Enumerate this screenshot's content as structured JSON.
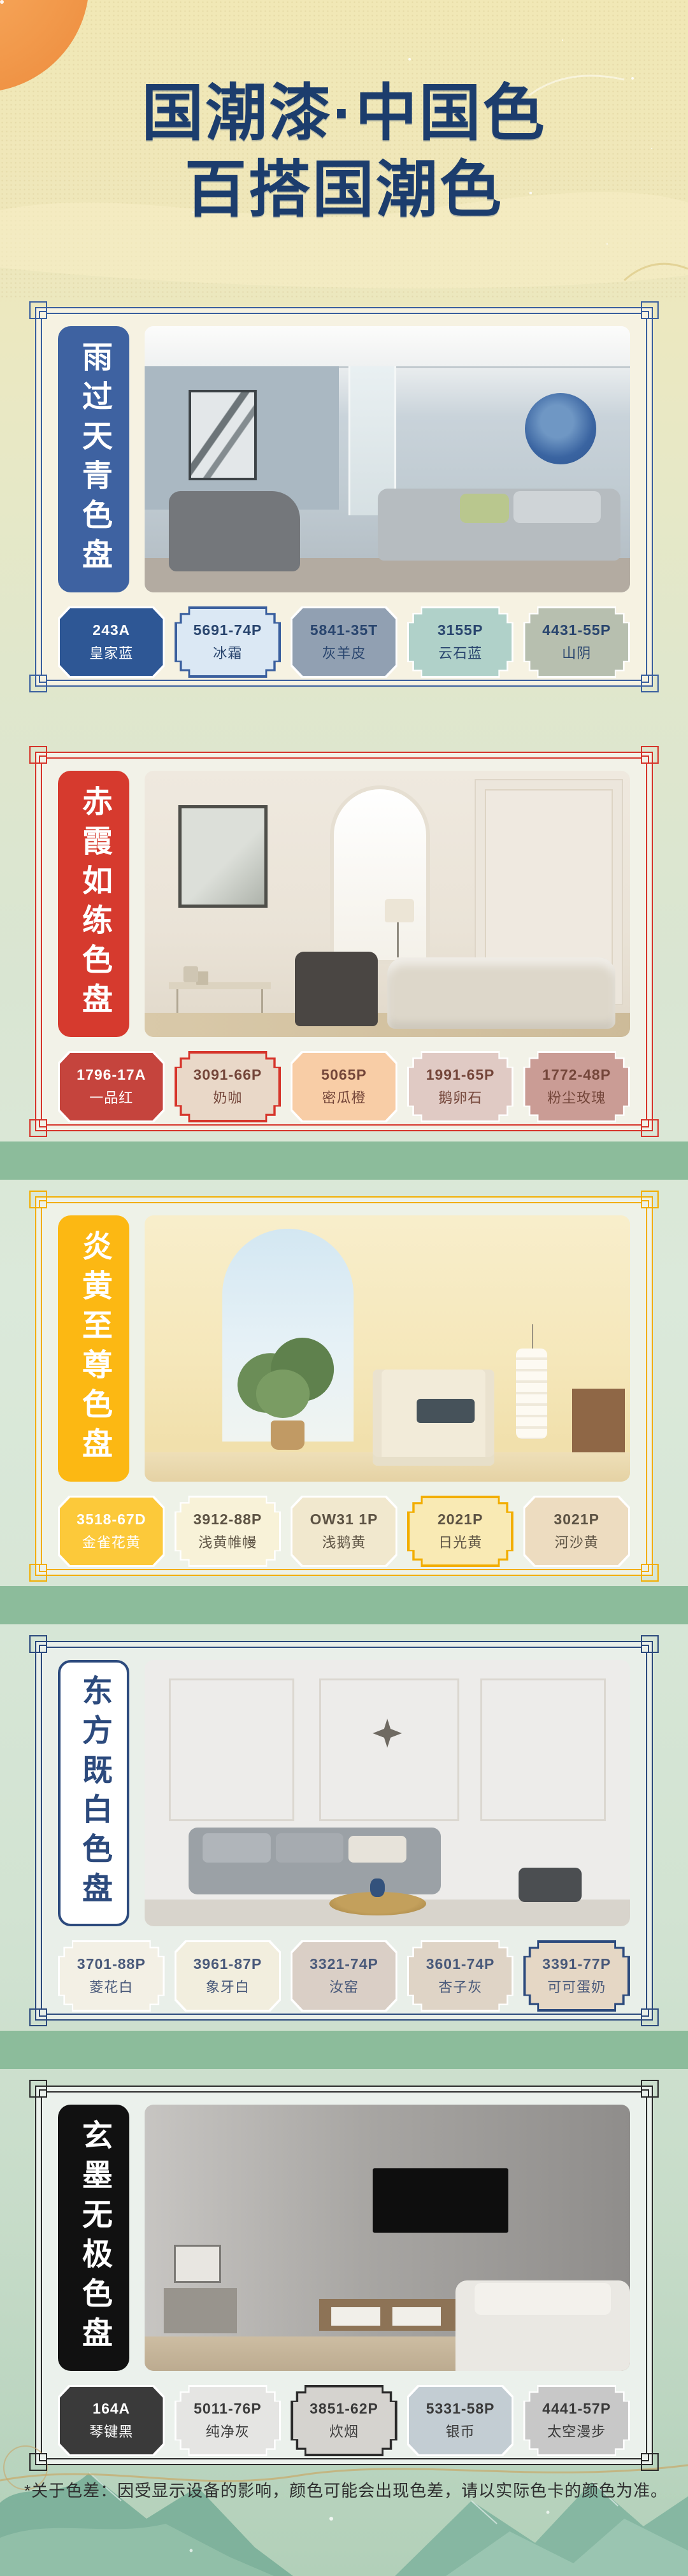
{
  "header": {
    "title_line1": "国潮漆·中国色",
    "title_line2": "百搭国潮色",
    "title_color": "#1c3d6d"
  },
  "footer": {
    "note": "*关于色差：因受显示设备的影响，颜色可能会出现色差，请以实际色卡的颜色为准。"
  },
  "page_colors": {
    "background_top": "#f1e8b6",
    "background_bottom": "#b2d0b9",
    "divider_stripe": "#8cbc9b",
    "sun": "#f29a4c"
  },
  "palettes": [
    {
      "title": "雨过天青色盘",
      "frame": "#3a5f9e",
      "banner_bg": "#3e62a1",
      "banner_text": "#ffffff",
      "banner_border": "",
      "card_bg": "#f6f2e2",
      "dark_text": "#29456e",
      "swatches": [
        {
          "code": "243A",
          "name": "皇家蓝",
          "color": "#2e5795",
          "light": false,
          "shape": "a",
          "outlined": false
        },
        {
          "code": "5691-74P",
          "name": "冰霜",
          "color": "#dbe8f4",
          "light": true,
          "shape": "b",
          "outlined": true
        },
        {
          "code": "5841-35T",
          "name": "灰羊皮",
          "color": "#91a0b2",
          "light": true,
          "shape": "a",
          "outlined": false
        },
        {
          "code": "3155P",
          "name": "云石蓝",
          "color": "#b0d1c9",
          "light": true,
          "shape": "b",
          "outlined": false
        },
        {
          "code": "4431-55P",
          "name": "山阴",
          "color": "#b7bfaf",
          "light": true,
          "shape": "b",
          "outlined": false
        }
      ]
    },
    {
      "title": "赤霞如练色盘",
      "frame": "#d6352b",
      "banner_bg": "#d63a2e",
      "banner_text": "#ffffff",
      "banner_border": "",
      "card_bg": "#f2f2e8",
      "dark_text": "#74463a",
      "swatches": [
        {
          "code": "1796-17A",
          "name": "一品红",
          "color": "#c5443d",
          "light": false,
          "shape": "a",
          "outlined": false
        },
        {
          "code": "3091-66P",
          "name": "奶咖",
          "color": "#e9d8c8",
          "light": true,
          "shape": "b",
          "outlined": true
        },
        {
          "code": "5065P",
          "name": "密瓜橙",
          "color": "#f8cda6",
          "light": true,
          "shape": "a",
          "outlined": false
        },
        {
          "code": "1991-65P",
          "name": "鹅卵石",
          "color": "#e0cac4",
          "light": true,
          "shape": "b",
          "outlined": false
        },
        {
          "code": "1772-48P",
          "name": "粉尘玫瑰",
          "color": "#ca9c95",
          "light": true,
          "shape": "b",
          "outlined": false
        }
      ]
    },
    {
      "title": "炎黄至尊色盘",
      "frame": "#f2ae00",
      "banner_bg": "#fcb813",
      "banner_text": "#ffffff",
      "banner_border": "",
      "card_bg": "#eef2e8",
      "dark_text": "#5c5243",
      "swatches": [
        {
          "code": "3518-67D",
          "name": "金雀花黄",
          "color": "#fcc93a",
          "light": false,
          "shape": "a",
          "outlined": false
        },
        {
          "code": "3912-88P",
          "name": "浅黄帷幔",
          "color": "#f8f2d8",
          "light": true,
          "shape": "b",
          "outlined": false
        },
        {
          "code": "OW31 1P",
          "name": "浅鹅黄",
          "color": "#f1e8ce",
          "light": true,
          "shape": "a",
          "outlined": false
        },
        {
          "code": "2021P",
          "name": "日光黄",
          "color": "#f9eab4",
          "light": true,
          "shape": "b",
          "outlined": true
        },
        {
          "code": "3021P",
          "name": "河沙黄",
          "color": "#eddcc0",
          "light": true,
          "shape": "a",
          "outlined": false
        }
      ]
    },
    {
      "title": "东方既白色盘",
      "frame": "#2c4a7d",
      "banner_bg": "#ffffff",
      "banner_text": "#2c4a7d",
      "banner_border": "#2c4a7d",
      "card_bg": "#e9efe9",
      "dark_text": "#49597a",
      "swatches": [
        {
          "code": "3701-88P",
          "name": "菱花白",
          "color": "#f3f0e5",
          "light": true,
          "shape": "b",
          "outlined": false
        },
        {
          "code": "3961-87P",
          "name": "象牙白",
          "color": "#f2eede",
          "light": true,
          "shape": "a",
          "outlined": false
        },
        {
          "code": "3321-74P",
          "name": "汝窑",
          "color": "#dacfc6",
          "light": true,
          "shape": "a",
          "outlined": false
        },
        {
          "code": "3601-74P",
          "name": "杏子灰",
          "color": "#dfd4c6",
          "light": true,
          "shape": "b",
          "outlined": false
        },
        {
          "code": "3391-77P",
          "name": "可可蛋奶",
          "color": "#e5d7c5",
          "light": true,
          "shape": "b",
          "outlined": true
        }
      ]
    },
    {
      "title": "玄墨无极色盘",
      "frame": "#2b2b2b",
      "banner_bg": "#111111",
      "banner_text": "#ffffff",
      "banner_border": "",
      "card_bg": "#ebf1ec",
      "dark_text": "#3a3a3a",
      "swatches": [
        {
          "code": "164A",
          "name": "琴键黑",
          "color": "#3a3a3a",
          "light": false,
          "shape": "a",
          "outlined": false
        },
        {
          "code": "5011-76P",
          "name": "纯净灰",
          "color": "#e5e5e3",
          "light": true,
          "shape": "b",
          "outlined": false
        },
        {
          "code": "3851-62P",
          "name": "炊烟",
          "color": "#d5d3cf",
          "light": true,
          "shape": "b",
          "outlined": true
        },
        {
          "code": "5331-58P",
          "name": "银币",
          "color": "#c3cdd3",
          "light": true,
          "shape": "a",
          "outlined": false
        },
        {
          "code": "4441-57P",
          "name": "太空漫步",
          "color": "#c8c8c8",
          "light": true,
          "shape": "b",
          "outlined": false
        }
      ]
    }
  ]
}
